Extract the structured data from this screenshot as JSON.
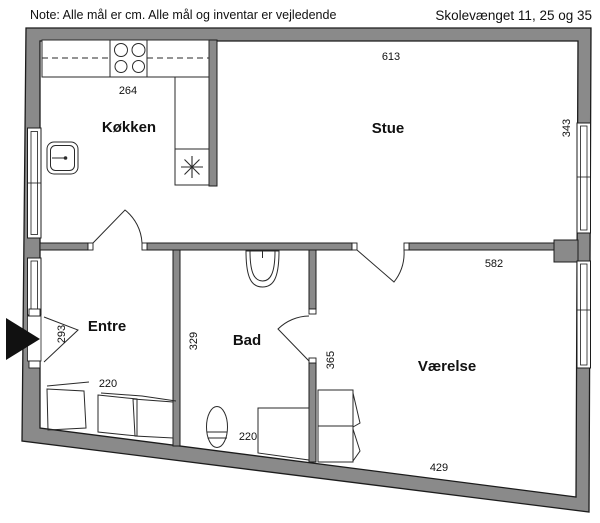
{
  "header": {
    "note": "Note: Alle mål er cm. Alle mål og inventar er vejledende",
    "address": "Skolevænget 11, 25 og 35"
  },
  "rooms": {
    "kitchen": "Køkken",
    "living": "Stue",
    "hall": "Entre",
    "bath": "Bad",
    "bedroom": "Værelse"
  },
  "dimensions": {
    "living_width": "613",
    "kitchen_width": "264",
    "living_depth": "343",
    "bedroom_top_width": "582",
    "entrance_opening": "293",
    "bath_depth": "329",
    "bath_door_wall": "365",
    "hall_wardrobe": "220",
    "bath_width": "220",
    "bedroom_bottom_width": "429"
  },
  "colors": {
    "wall": "#8a8a8a",
    "outline": "#1c1c1c",
    "background": "#ffffff"
  }
}
